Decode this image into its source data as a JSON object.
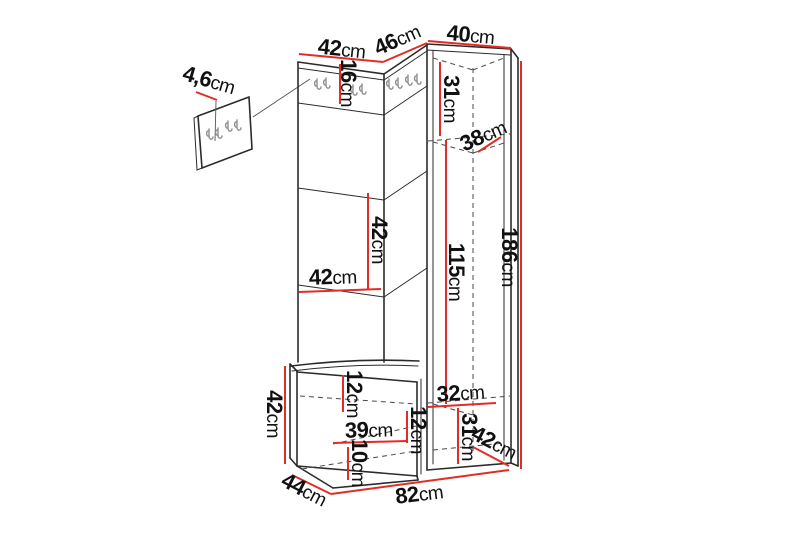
{
  "colors": {
    "background": "#ffffff",
    "line": "#2b2b2b",
    "dash": "#4a4a4a",
    "red": "#e02d26",
    "hook": "#8f8f8f",
    "text": "#111111"
  },
  "dimensions": {
    "top_left_width": {
      "value": "42",
      "unit": "cm"
    },
    "top_mid_width": {
      "value": "46",
      "unit": "cm"
    },
    "top_right_width": {
      "value": "40",
      "unit": "cm"
    },
    "hook_panel_height": {
      "value": "16",
      "unit": "cm"
    },
    "panel_thickness": {
      "value": "4,6",
      "unit": "cm"
    },
    "cab_top_height": {
      "value": "31",
      "unit": "cm"
    },
    "cab_inner_depth": {
      "value": "38",
      "unit": "cm"
    },
    "cab_mid_height": {
      "value": "115",
      "unit": "cm"
    },
    "total_height": {
      "value": "186",
      "unit": "cm"
    },
    "mid_panel_height": {
      "value": "42",
      "unit": "cm"
    },
    "mid_panel_width": {
      "value": "42",
      "unit": "cm"
    },
    "bench_height": {
      "value": "42",
      "unit": "cm"
    },
    "bench_depth": {
      "value": "44",
      "unit": "cm"
    },
    "total_width": {
      "value": "82",
      "unit": "cm"
    },
    "drawer_top_height": {
      "value": "12",
      "unit": "cm"
    },
    "drawer_width": {
      "value": "39",
      "unit": "cm"
    },
    "drawer_mid_height": {
      "value": "12",
      "unit": "cm"
    },
    "drawer_bottom_height": {
      "value": "10",
      "unit": "cm"
    },
    "cab_bottom_width": {
      "value": "32",
      "unit": "cm"
    },
    "cab_bottom_height": {
      "value": "31",
      "unit": "cm"
    },
    "cab_bottom_depth": {
      "value": "42",
      "unit": "cm"
    }
  }
}
